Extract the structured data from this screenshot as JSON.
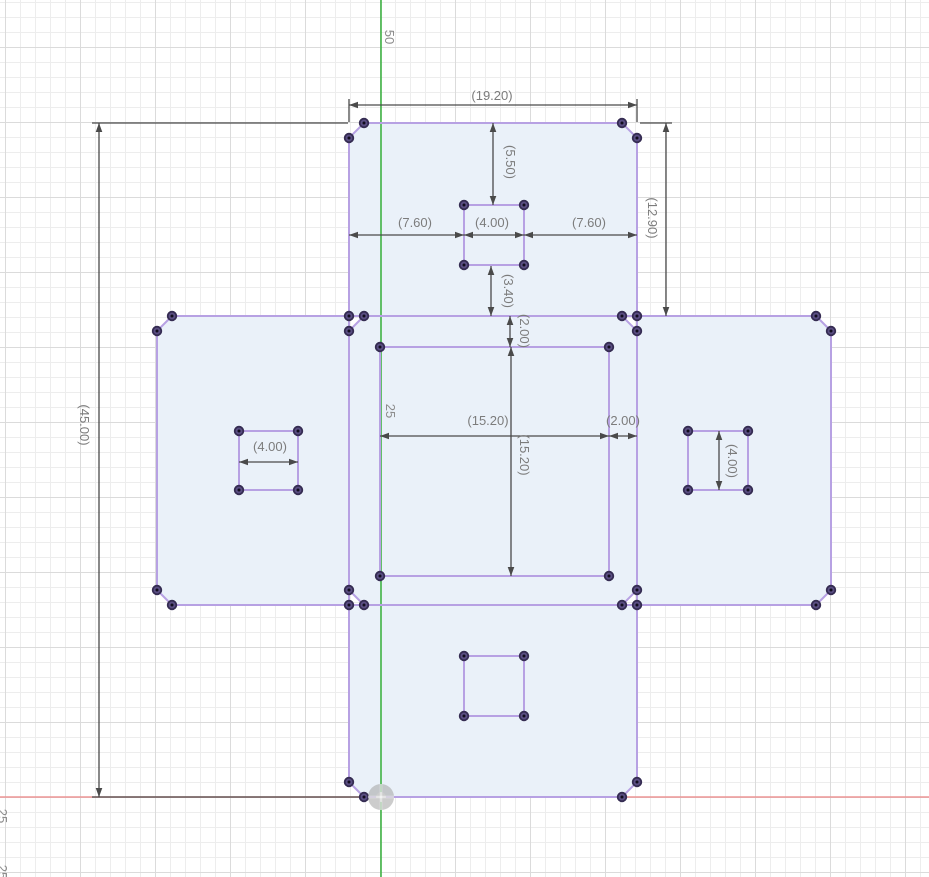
{
  "app": "cad-sketch-viewport",
  "canvas": {
    "width": 929,
    "height": 877
  },
  "colors": {
    "background": "#ffffff",
    "grid_minor": "#ededed",
    "grid_major": "#dbdbdb",
    "axis_vertical_green": "#3fb344",
    "axis_horizontal_red": "#ed9595",
    "profile_fill": "#eaf1f9",
    "profile_edge": "#b7a1e3",
    "point_fill": "#5a4e83",
    "point_ring": "#352c52",
    "point_core": "#120d1f",
    "dimension_line": "#4a4a4a",
    "dimension_text": "#7c7c7c",
    "grid_label_text": "#8c8c8c",
    "origin_fill": "#a3a3a3",
    "origin_inner": "#cccccc"
  },
  "axes": {
    "vertical": {
      "name": "y-axis",
      "x": 381
    },
    "horizontal": {
      "name": "x-axis",
      "y": 797
    }
  },
  "origin": {
    "x": 381,
    "y": 797,
    "radius": 13
  },
  "grid_labels": [
    {
      "text": "50",
      "x": 389,
      "y": 37
    },
    {
      "text": "25",
      "x": 390,
      "y": 411
    },
    {
      "text": "25",
      "x": 2,
      "y": 816
    },
    {
      "text": "25",
      "x": 2,
      "y": 872
    }
  ],
  "faces": [
    {
      "name": "face-top",
      "pts": [
        [
          364,
          123
        ],
        [
          622,
          123
        ],
        [
          637,
          138
        ],
        [
          637,
          316
        ],
        [
          349,
          316
        ],
        [
          349,
          138
        ]
      ]
    },
    {
      "name": "face-left",
      "pts": [
        [
          172,
          316
        ],
        [
          349,
          316
        ],
        [
          349,
          605
        ],
        [
          172,
          605
        ],
        [
          157,
          590
        ],
        [
          157,
          331
        ]
      ]
    },
    {
      "name": "face-center",
      "pts": [
        [
          364,
          316
        ],
        [
          622,
          316
        ],
        [
          637,
          331
        ],
        [
          637,
          590
        ],
        [
          622,
          605
        ],
        [
          364,
          605
        ],
        [
          349,
          590
        ],
        [
          349,
          331
        ]
      ]
    },
    {
      "name": "face-right",
      "pts": [
        [
          637,
          316
        ],
        [
          816,
          316
        ],
        [
          831,
          331
        ],
        [
          831,
          590
        ],
        [
          816,
          605
        ],
        [
          637,
          605
        ]
      ]
    },
    {
      "name": "face-bottom",
      "pts": [
        [
          349,
          605
        ],
        [
          637,
          605
        ],
        [
          637,
          782
        ],
        [
          622,
          797
        ],
        [
          364,
          797
        ],
        [
          349,
          782
        ]
      ]
    }
  ],
  "inner_squares": [
    {
      "name": "inner-square-top",
      "x": 464,
      "y": 205,
      "w": 60,
      "h": 60
    },
    {
      "name": "inner-square-center",
      "x": 380,
      "y": 347,
      "w": 229,
      "h": 229
    },
    {
      "name": "inner-square-left",
      "x": 239,
      "y": 431,
      "w": 59,
      "h": 59
    },
    {
      "name": "inner-square-right",
      "x": 688,
      "y": 431,
      "w": 60,
      "h": 59
    },
    {
      "name": "inner-square-bottom",
      "x": 464,
      "y": 656,
      "w": 60,
      "h": 60
    }
  ],
  "extension_lines": [
    [
      349,
      99,
      349,
      122
    ],
    [
      637,
      99,
      637,
      122
    ],
    [
      640,
      123,
      672,
      123
    ],
    [
      92,
      123,
      348,
      123
    ],
    [
      92,
      797,
      363,
      797
    ]
  ],
  "dimensions": [
    {
      "name": "dim-width-top",
      "o": "h",
      "y": 105,
      "x1": 349,
      "x2": 637,
      "label": "(19.20)",
      "lx": 492,
      "ly": 96
    },
    {
      "name": "dim-top-square-offset",
      "o": "v",
      "x": 493,
      "y1": 123,
      "y2": 205,
      "label": "(5.50)",
      "lx": 510,
      "ly": 162
    },
    {
      "name": "dim-top-left-gap",
      "o": "h",
      "y": 235,
      "x1": 349,
      "x2": 464,
      "label": "(7.60)",
      "lx": 415,
      "ly": 223
    },
    {
      "name": "dim-top-square-width",
      "o": "h",
      "y": 235,
      "x1": 464,
      "x2": 524,
      "label": "(4.00)",
      "lx": 492,
      "ly": 223
    },
    {
      "name": "dim-top-right-gap",
      "o": "h",
      "y": 235,
      "x1": 524,
      "x2": 637,
      "label": "(7.60)",
      "lx": 589,
      "ly": 223
    },
    {
      "name": "dim-top-face-height",
      "o": "v",
      "x": 666,
      "y1": 123,
      "y2": 316,
      "label": "(12.90)",
      "lx": 652,
      "ly": 218
    },
    {
      "name": "dim-top-square-bottom",
      "o": "v",
      "x": 491,
      "y1": 266,
      "y2": 316,
      "label": "(3.40)",
      "lx": 508,
      "ly": 291
    },
    {
      "name": "dim-center-top-inset",
      "o": "v",
      "x": 510,
      "y1": 316,
      "y2": 347,
      "label": "(2.00)",
      "lx": 524,
      "ly": 331
    },
    {
      "name": "dim-center-square-w",
      "o": "h",
      "y": 436,
      "x1": 380,
      "x2": 609,
      "label": "(15.20)",
      "lx": 488,
      "ly": 421
    },
    {
      "name": "dim-center-square-h",
      "o": "v",
      "x": 511,
      "y1": 347,
      "y2": 576,
      "label": "(15.20)",
      "lx": 524,
      "ly": 455
    },
    {
      "name": "dim-center-right-inset",
      "o": "h",
      "y": 436,
      "x1": 609,
      "x2": 637,
      "label": "(2.00)",
      "lx": 623,
      "ly": 421
    },
    {
      "name": "dim-overall-height",
      "o": "v",
      "x": 99,
      "y1": 123,
      "y2": 797,
      "label": "(45.00)",
      "lx": 84,
      "ly": 425
    },
    {
      "name": "dim-left-square-width",
      "o": "h",
      "y": 462,
      "x1": 239,
      "x2": 298,
      "label": "(4.00)",
      "lx": 270,
      "ly": 447
    },
    {
      "name": "dim-right-square-height",
      "o": "v",
      "x": 719,
      "y1": 431,
      "y2": 490,
      "label": "(4.00)",
      "lx": 732,
      "ly": 461
    }
  ]
}
